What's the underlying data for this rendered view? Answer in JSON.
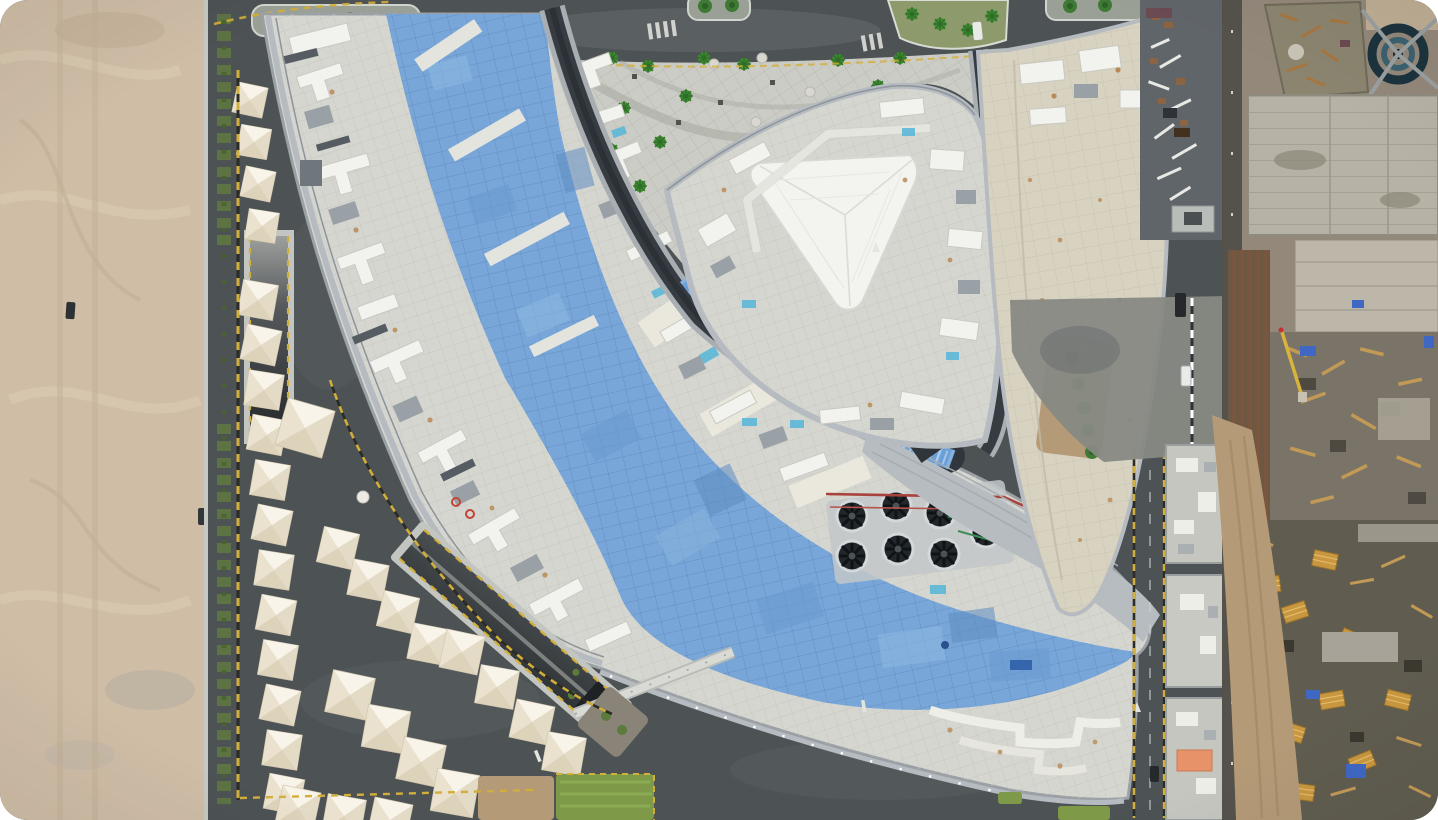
{
  "meta": {
    "type": "aerial-photograph",
    "subject": "Top-down drone photo of a large curved shopping-mall complex under construction beside a desert lot",
    "no_visible_text": true
  },
  "photo": {
    "alt": "Aerial top-down view: a crescent-shaped building with a wide light-blue tiled roof sweeps from the upper left to the lower right; a triangular building with a white triangular skylight dome sits at the top center beside a paved plaza with small palm trees; white tensile canopy tents and a dark parking lot line the left edge next to a tan sand lot; a busy construction yard with concrete slabs, wooden formwork and blue tarps fills the right edge; roads with yellow-and-black curbs wrap around the buildings",
    "width_px": 1438,
    "height_px": 820,
    "corner_radius_px": 28
  },
  "palette": {
    "sand": "#cfbda6",
    "sand_light": "#ddcdb5",
    "asphalt": "#4d5255",
    "asphalt_light": "#5d6366",
    "road_concrete": "#878983",
    "paving": "#cbccc5",
    "roof_deck": "#d6d6d0",
    "roof_white": "#f2f2ee",
    "roof_tan": "#d8d2c1",
    "blue_roof": "#78a6d8",
    "blue_glass": "#6aa0d8",
    "canyon_dark": "#363c41",
    "metal_band": "#b6bcc0",
    "tent": "#efe9db",
    "hedge": "#5d7344",
    "tree_green": "#3f8a33",
    "lawn": "#7e9a48",
    "dirt": "#b49a77",
    "construction_base": "#93887a",
    "concrete_slab": "#b6b2a6",
    "wood": "#c9973f",
    "rust": "#b98a55",
    "tarp_blue": "#3f68c4",
    "tarp_cyan": "#5bb8d8",
    "orange_roof": "#e8926a",
    "curb_yellow": "#d2ae3a",
    "fan_dark": "#22272b",
    "pipe_red": "#a8423c",
    "pipe_green": "#2f7d46",
    "vehicle_dark": "#26292c",
    "dome_white": "#f3f3ef"
  },
  "scene": {
    "areas": [
      {
        "name": "desert-sand-lot",
        "position": "left edge"
      },
      {
        "name": "canopy-tent-rows",
        "position": "left and lower-left"
      },
      {
        "name": "parking-lot",
        "position": "lower-left"
      },
      {
        "name": "crescent-building-blue-roof",
        "position": "center, sweeping top-left to lower-right"
      },
      {
        "name": "triangle-building-with-dome",
        "position": "top center"
      },
      {
        "name": "pedestrian-plaza-with-palms",
        "position": "top center-left of triangle"
      },
      {
        "name": "east-wing-building",
        "position": "top right of triangle"
      },
      {
        "name": "service-road-strip",
        "position": "right"
      },
      {
        "name": "construction-yard",
        "position": "far right"
      },
      {
        "name": "ring-roads",
        "position": "top and bottom"
      }
    ],
    "objects": {
      "canopy_tents": 34,
      "rooftop_cooling_fans": 7,
      "palm_trees_plaza": 16,
      "median_trees": 10,
      "lumber_stacks": 10,
      "blue_tarps": 6,
      "vehicles": 6,
      "skylight_domes": 1,
      "underpass_ramps": 2,
      "footbridges": 1
    }
  }
}
